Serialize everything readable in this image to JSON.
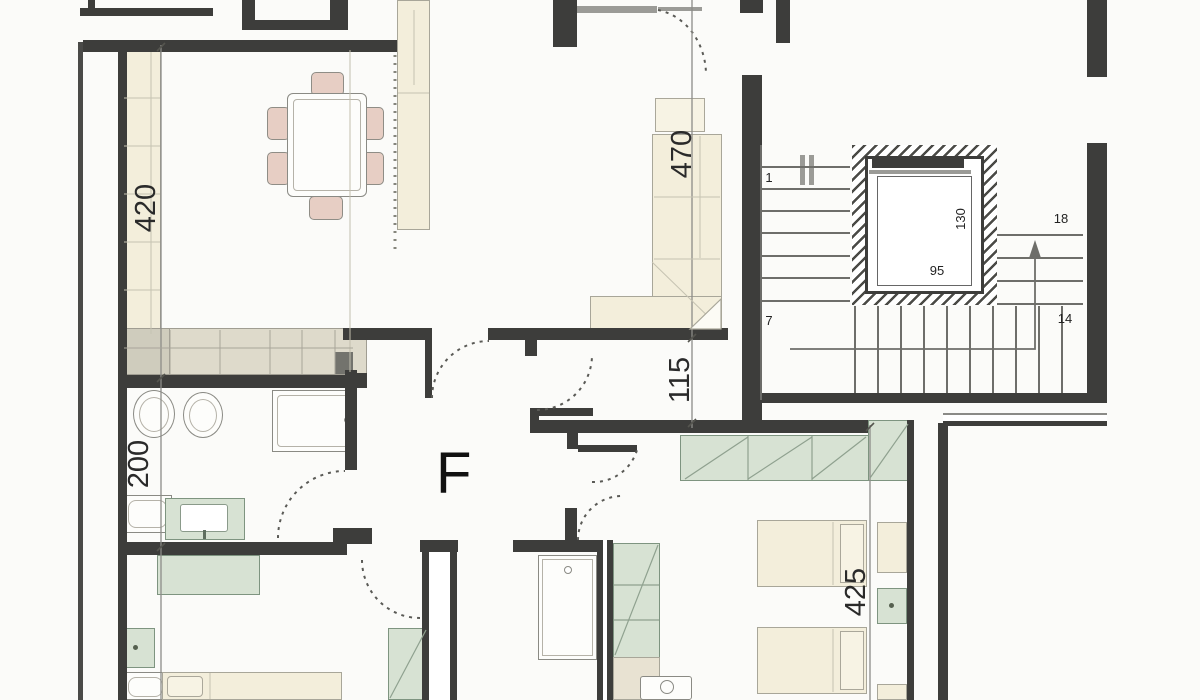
{
  "plan": {
    "unit_label": "F",
    "dimensions": {
      "living_width": "420",
      "bathroom_depth": "200",
      "living_depth": "470",
      "corridor_width": "115",
      "bedroom_depth": "425"
    },
    "stairwell": {
      "step_first": "1",
      "step_7": "7",
      "step_14": "14",
      "step_18": "18",
      "elevator_width": "95",
      "elevator_depth": "130"
    },
    "colors": {
      "wall": "#3d3d3b",
      "furniture_cream": "#f3eedb",
      "furniture_green": "#d7e2d3",
      "furniture_pink": "#e7cec4",
      "counter_tan": "#dedacb",
      "line_gray": "#6e6e6a"
    }
  }
}
